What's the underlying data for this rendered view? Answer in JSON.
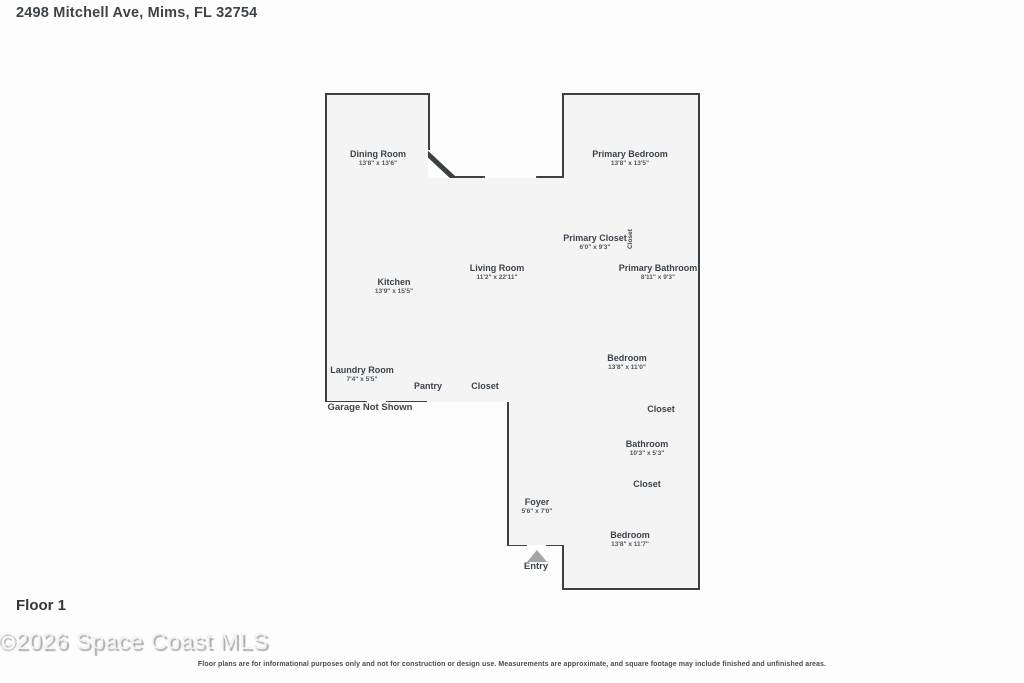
{
  "page": {
    "title": "2498 Mitchell Ave, Mims, FL 32754",
    "floor_label": "Floor 1",
    "watermark": "©2026 Space Coast MLS",
    "disclaimer": "Floor plans are for informational purposes only and not for construction or design use. Measurements are approximate, and square footage may include finished and unfinished areas."
  },
  "rooms": {
    "dining": {
      "name": "Dining Room",
      "dims": "13'8\" x 13'6\""
    },
    "primary_bedroom": {
      "name": "Primary Bedroom",
      "dims": "13'8\" x 13'5\""
    },
    "primary_closet": {
      "name": "Primary Closet",
      "dims": "6'0\" x 9'3\""
    },
    "closet_vertical": {
      "name": "Closet"
    },
    "primary_bathroom": {
      "name": "Primary Bathroom",
      "dims": "8'11\" x 9'3\""
    },
    "living": {
      "name": "Living Room",
      "dims": "11'2\" x 22'11\""
    },
    "kitchen": {
      "name": "Kitchen",
      "dims": "13'9\" x 15'5\""
    },
    "bedroom_mid": {
      "name": "Bedroom",
      "dims": "13'8\" x 11'0\""
    },
    "laundry": {
      "name": "Laundry Room",
      "dims": "7'4\" x 5'5\""
    },
    "pantry": {
      "name": "Pantry"
    },
    "closet_mid": {
      "name": "Closet"
    },
    "bathroom": {
      "name": "Bathroom",
      "dims": "10'3\" x 5'3\""
    },
    "closet_lower": {
      "name": "Closet"
    },
    "foyer": {
      "name": "Foyer",
      "dims": "5'6\" x 7'0\""
    },
    "bedroom_lower": {
      "name": "Bedroom",
      "dims": "13'8\" x 11'7\""
    }
  },
  "annotations": {
    "garage_note": "Garage Not Shown",
    "entry_label": "Entry"
  },
  "colors": {
    "wall": "#3c4043",
    "room_fill": "#f4f4f4",
    "window_fill": "#ececec",
    "label_text": "#3d434a",
    "watermark_gray": "#a9a9a9"
  }
}
